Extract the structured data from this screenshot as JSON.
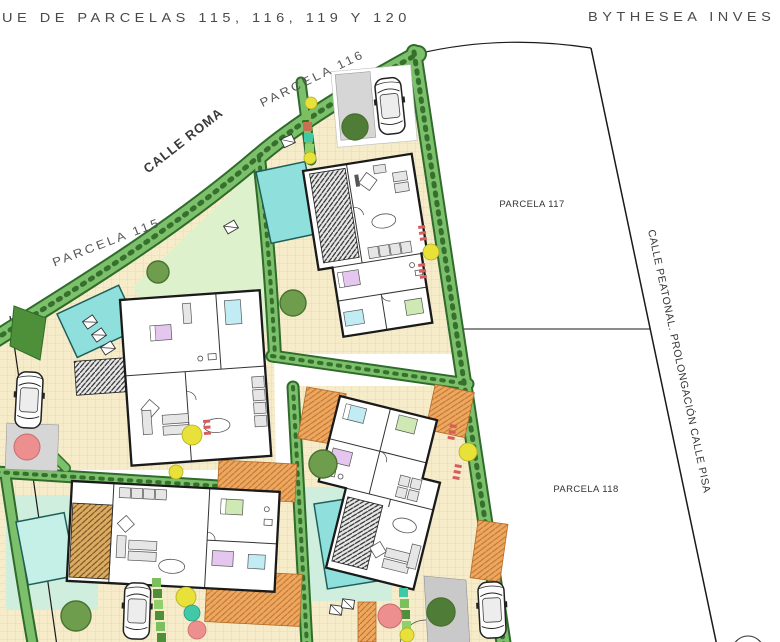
{
  "document": {
    "kind": "architectural site plan drawing"
  },
  "header": {
    "title_left": "UE DE PARCELAS 115, 116, 119 Y 120",
    "title_right": "BYTHESEA INVES"
  },
  "streets": {
    "calle_roma": "CALLE ROMA",
    "calle_peatonal": "CALLE PEATONAL. PROLONGACIÓN CALLE PISA"
  },
  "parcels": [
    {
      "id": "115",
      "label": "PARCELA 115",
      "type": "villa with pool"
    },
    {
      "id": "116",
      "label": "PARCELA 116",
      "type": "villa with pool"
    },
    {
      "id": "117",
      "label": "PARCELA 117",
      "type": "empty lot"
    },
    {
      "id": "118",
      "label": "PARCELA 118",
      "type": "empty lot"
    }
  ],
  "palette": {
    "hedge": "#7cc06c",
    "hedge_dark": "#2f6b2a",
    "patio": "#f6ecca",
    "patio_grid": "#e7d7a8",
    "lawn": "#ddf2cc",
    "pool_lawn": "#cfeedd",
    "pool": "#8fe0dc",
    "pool_pale": "#c4f0e8",
    "deck_line": "#2b2b2b",
    "wood_deck": "#d9ad62",
    "pergola": "#eda75f",
    "driveway": "#d6d6d6",
    "wall": "#1a1a1a",
    "tree": "#6e9d4e",
    "tree_dark": "#4f7d38",
    "dot_yellow": "#e7e13a",
    "dot_pink": "#ee8f8f",
    "dot_teal": "#3fc9a7",
    "tick_red": "#d85c5c",
    "line": "#1a1a1a",
    "title_text": "#4a4a4a"
  }
}
